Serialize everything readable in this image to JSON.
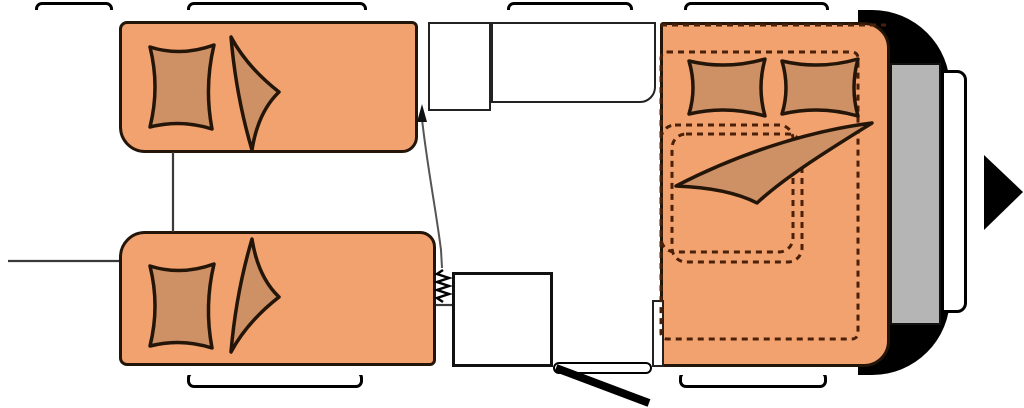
{
  "meta": {
    "description": "Caravan floor plan diagram, no visible text labels",
    "view": "top-down"
  },
  "colors": {
    "wall": "#000000",
    "bed": "#F2A26F",
    "accent": "#CE9065",
    "outline": "#241509",
    "dash": "#4A2008",
    "panel": "#B5B5B5"
  },
  "icons": [
    {
      "name": "direction-arrow-icon",
      "meaning": "arrow pointing right at caravan front"
    }
  ],
  "windows": {
    "top": [
      {
        "x": 35,
        "w": 78
      },
      {
        "x": 187,
        "w": 180
      },
      {
        "x": 507,
        "w": 126
      },
      {
        "x": 684,
        "w": 145
      }
    ],
    "bottom": [
      {
        "x": 187,
        "w": 176
      },
      {
        "x": 679,
        "w": 148
      }
    ]
  },
  "furniture": {
    "single_beds": 2,
    "front_bed": 1,
    "pillows_total": 4,
    "kitchen_block": 1,
    "washroom_cabinets": 2,
    "entry_door": 1,
    "drawbar_panel": 1
  }
}
